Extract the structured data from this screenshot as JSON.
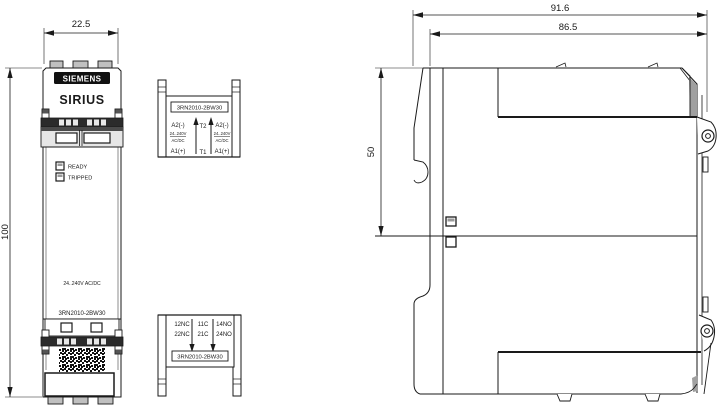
{
  "drawing": {
    "front_view": {
      "brand": "SIEMENS",
      "product_line": "SIRIUS",
      "led_ready": "READY",
      "led_tripped": "TRIPPED",
      "voltage": "24..240V AC/DC",
      "model": "3RN2010-2BW30"
    },
    "top_view": {
      "model": "3RN2010-2BW30",
      "left": [
        "A2(-)",
        "24..240V",
        "AC/DC",
        "A1(+)"
      ],
      "middle": [
        "T2",
        "T1"
      ],
      "right": [
        "A2(-)",
        "24..240V",
        "AC/DC",
        "A1(+)"
      ]
    },
    "bottom_view": {
      "model": "3RN2010-2BW30",
      "row1": [
        "12NC",
        "11C",
        "14NO"
      ],
      "row2": [
        "22NC",
        "21C",
        "24NO"
      ]
    },
    "dimensions": {
      "width": "22.5",
      "height": "100",
      "depth_total": "91.6",
      "depth_body": "86.5",
      "side_height": "50"
    },
    "colors": {
      "line": "#1a1a1a",
      "logo_background": "#111111",
      "terminal_bar": "#2b2b2b",
      "gray_fill": "#c0c0c0",
      "shade_gray": "#a0a0a0"
    }
  }
}
